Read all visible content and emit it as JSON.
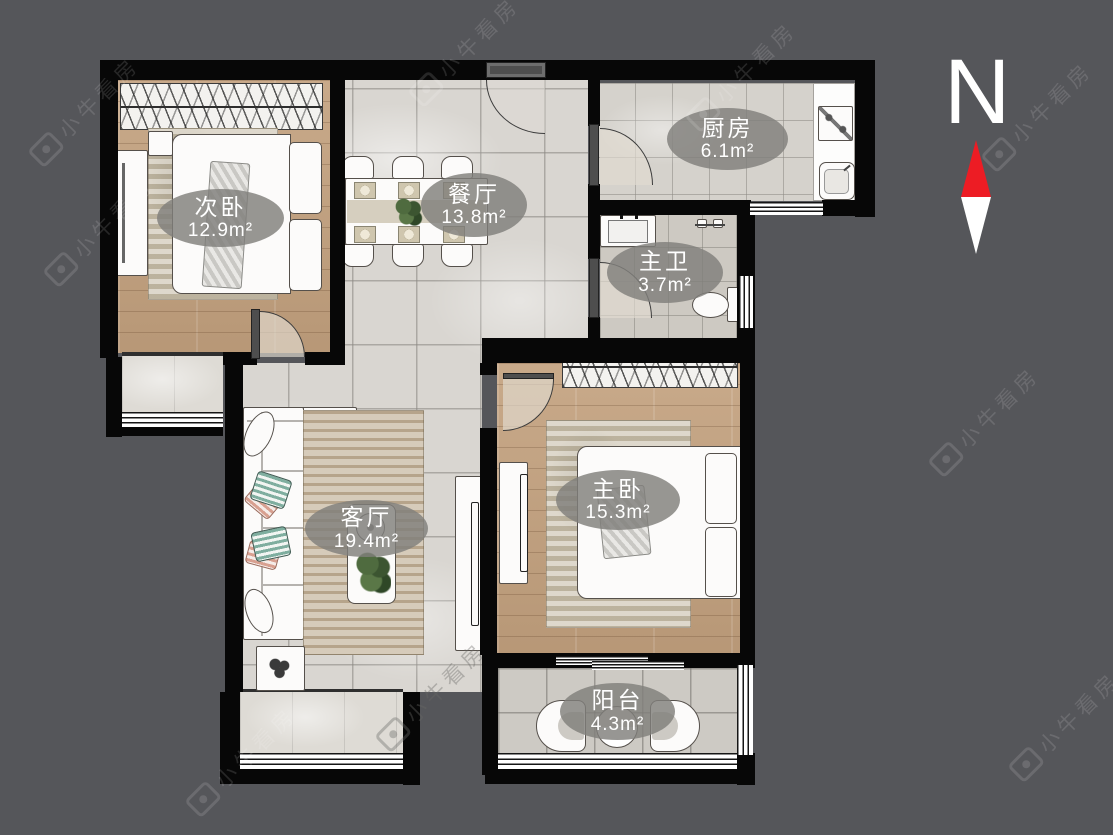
{
  "compass": {
    "label": "N"
  },
  "watermark": {
    "text": "小牛看房"
  },
  "rooms": [
    {
      "id": "secondary-bedroom",
      "name": "次卧",
      "area": "12.9m²"
    },
    {
      "id": "dining-room",
      "name": "餐厅",
      "area": "13.8m²"
    },
    {
      "id": "kitchen",
      "name": "厨房",
      "area": "6.1m²"
    },
    {
      "id": "master-bathroom",
      "name": "主卫",
      "area": "3.7m²"
    },
    {
      "id": "living-room",
      "name": "客厅",
      "area": "19.4m²"
    },
    {
      "id": "master-bedroom",
      "name": "主卧",
      "area": "15.3m²"
    },
    {
      "id": "balcony",
      "name": "阳台",
      "area": "4.3m²"
    }
  ],
  "colors": {
    "background": "#55565a",
    "wall": "#070707",
    "label_bubble": "#807f7b",
    "north_red": "#ed1c24",
    "wood_floor": "#c3a17e",
    "tile_floor": "#d9d6d1"
  }
}
